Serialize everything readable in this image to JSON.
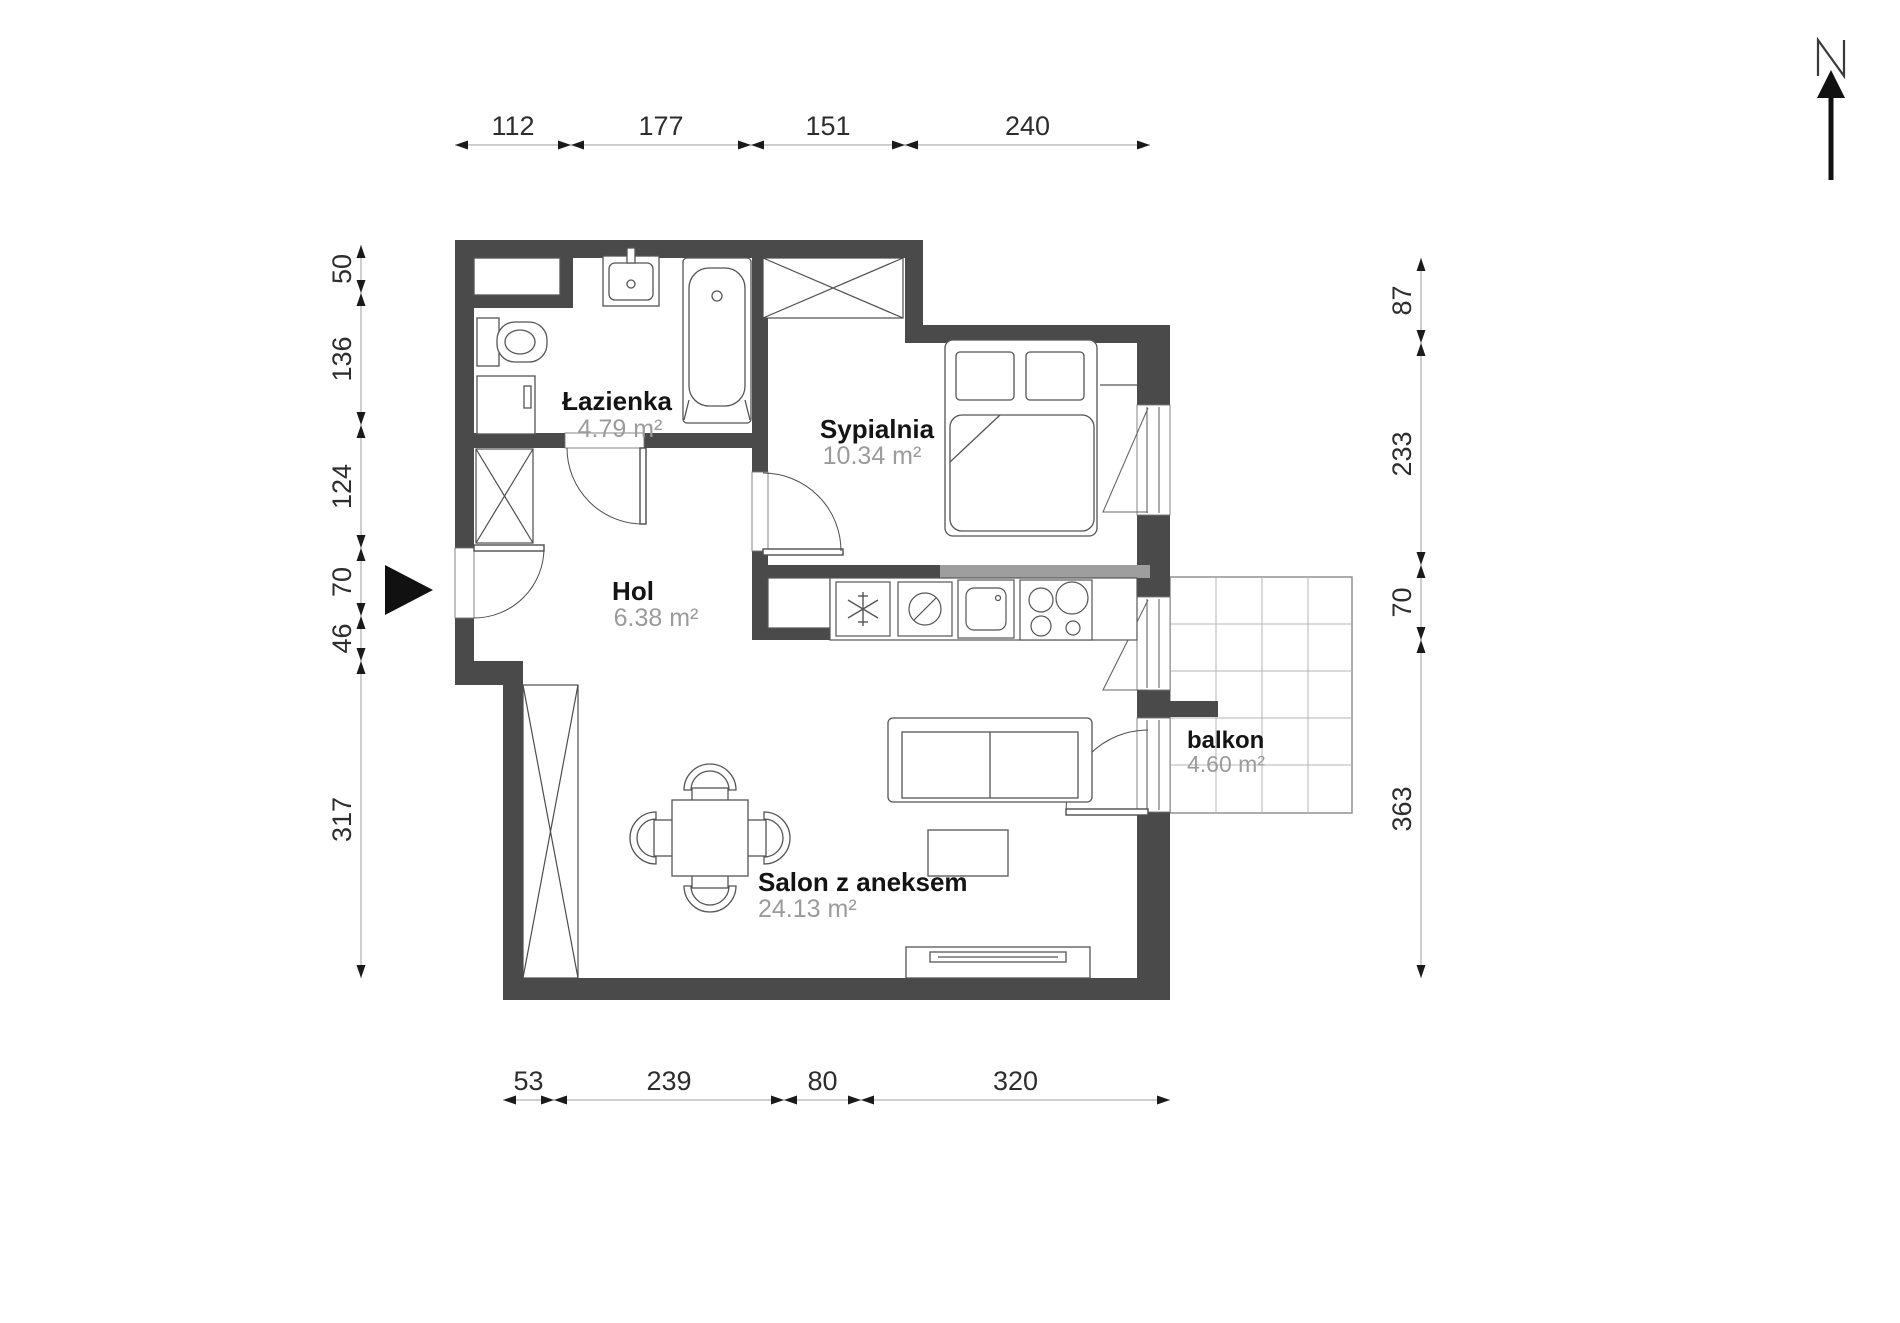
{
  "title": "apartment-floor-plan",
  "north": {
    "label": "N"
  },
  "rooms": {
    "lazienka": {
      "name": "Łazienka",
      "area": "4.79 m²"
    },
    "sypialnia": {
      "name": "Sypialnia",
      "area": "10.34 m²"
    },
    "hol": {
      "name": "Hol",
      "area": "6.38 m²"
    },
    "salon": {
      "name": "Salon z aneksem",
      "area": "24.13 m²"
    },
    "balkon": {
      "name": "balkon",
      "area": "4.60 m²"
    }
  },
  "dimensions": {
    "top": [
      "112",
      "177",
      "151",
      "240"
    ],
    "bottom": [
      "53",
      "239",
      "80",
      "320"
    ],
    "left": [
      "50",
      "136",
      "124",
      "70",
      "46",
      "317"
    ],
    "right": [
      "87",
      "233",
      "70",
      "363"
    ]
  },
  "colors": {
    "wall": "#4a4a4a",
    "wall_light": "#9e9e9e",
    "furniture_line": "#555555",
    "thin_line": "#8a8a8a",
    "grid_line": "#b5b5b5",
    "dim_line": "#9e9e9e",
    "dim_text": "#2d2d2d",
    "arrow": "#1a1a1a",
    "name_text": "#141414",
    "area_text": "#9b9b9b"
  },
  "icons": {
    "fridge": "snowflake-icon",
    "dishwasher": "circle-slash-icon",
    "sink": "basin-icon",
    "stove": "burners-icon",
    "north": "north-arrow-icon",
    "entrance": "entrance-arrow-icon"
  }
}
